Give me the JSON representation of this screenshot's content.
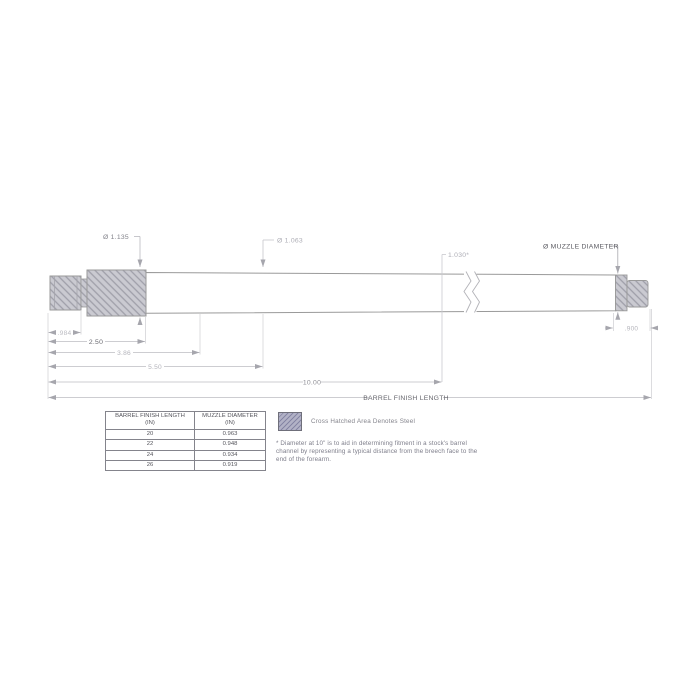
{
  "drawing": {
    "labels": {
      "chamber_dia": "Ø 1.135",
      "breech_dia": "Ø 1.063",
      "dia_at_10in": "1.030*",
      "muzzle_dia": "Ø MUZZLE DIAMETER"
    },
    "dims": {
      "tenon": ".984",
      "chamber": "2.50",
      "taper1": "3.86",
      "taper2": "5.50",
      "ten_inch": "10.00",
      "finish_length": "BARREL FINISH LENGTH",
      "muzzle_thread": ".900"
    }
  },
  "table": {
    "col1_title": "BARREL FINISH LENGTH",
    "col1_unit": "(IN)",
    "col2_title": "MUZZLE DIAMETER",
    "col2_unit": "(IN)",
    "rows": [
      [
        "20",
        "0.963"
      ],
      [
        "22",
        "0.948"
      ],
      [
        "24",
        "0.934"
      ],
      [
        "26",
        "0.919"
      ]
    ]
  },
  "legend": {
    "label": "Cross Hatched Area Denotes Steel"
  },
  "footnote": {
    "text": "* Diameter at 10\" is to aid in determining fitment in a stock's barrel channel by representing a typical distance from the breech face to the end of the forearm."
  },
  "colors": {
    "steel_fill": "#cacad1",
    "steel_hatch": "#9f9fa9",
    "legend_fill": "#b2b2c6",
    "legend_hatch": "#8585a4",
    "outline": "#9a9a9a",
    "dim_line": "#bbbbbb",
    "dark_text": "#555555",
    "light_text": "#a9a9b0"
  }
}
